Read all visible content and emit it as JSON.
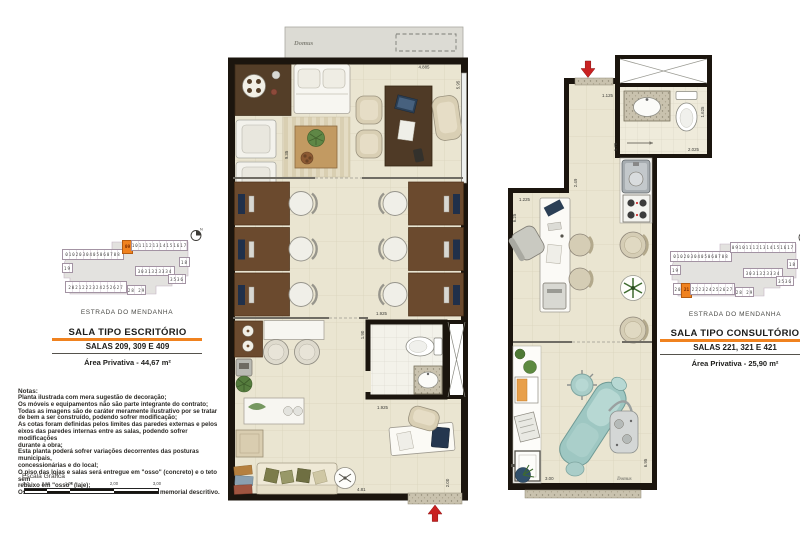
{
  "brand": {
    "logo_text": "Domus"
  },
  "left_panel": {
    "keyplan": {
      "north": "N",
      "street": "ESTRADA DO MENDANHA",
      "row2": "0102030405060708",
      "hl": "09",
      "top_right": "1011121314151617",
      "u18": "18",
      "u19": "19",
      "mid": "3031323334",
      "mid2": "3536",
      "bottom": "2021222324252627",
      "bottom2": "28 29"
    },
    "title": "SALA TIPO ESCRITÓRIO",
    "subtitle": "SALAS 209, 309 E 409",
    "area": "Área Privativa - 44,67 m²",
    "notes_title": "Notas:",
    "notes_body": "Planta ilustrada com mera sugestão de decoração;\nOs móveis e equipamentos não são parte integrante do contrato;\nTodas as imagens são de caráter meramente ilustrativo por se tratar\nde bem a ser construído, podendo sofrer modificação;\nAs cotas foram definidas pelos limites das paredes externas e pelos\neixos das paredes internas entre as salas, podendo sofrer modificações\ndurante a obra;\nEsta planta poderá sofrer variações decorrentes das posturas municipais,\nconcessionárias e do local;\nO piso das lojas e salas será entregue em \"osso\" (concreto) e o teto sem\nrebaixo em \"osso\" (laje);\nOs revestimentos serão executados conforme o memorial descritivo.",
    "scale_title": "Escala Gráfica",
    "scale_ticks": [
      "0,0",
      "0,50",
      "1,00",
      "2,00",
      "3,00"
    ]
  },
  "right_panel": {
    "keyplan": {
      "north": "N",
      "street": "ESTRADA DO MENDANHA",
      "row2": "0102030405060708",
      "top": "091011121314151617",
      "u18": "18",
      "u19": "19",
      "mid": "3031323334",
      "mid2": "3536",
      "bottom_pre": "20",
      "hl": "21",
      "bottom_post": "222324252627",
      "bottom2": "28 29"
    },
    "title": "SALA TIPO CONSULTÓRIO",
    "subtitle": "SALAS 221, 321 E 421",
    "area": "Área Privativa - 25,90 m²"
  },
  "plan_escritorio": {
    "dims": {
      "top_width": "4.885",
      "right_depth": "5.95",
      "left_depth": "9.35",
      "mid_opening": "1.925",
      "wc_width": "1.90",
      "wc_opening": "1.925",
      "bottom_width": "4.81",
      "entry_depth": "2.00"
    }
  },
  "plan_consultorio": {
    "dims": {
      "entry_width": "1.125",
      "corridor_depth": "1.70",
      "corridor_depth2": "2.49",
      "wc_depth": "1.625",
      "wc_width": "2.025",
      "room_width": "1.225",
      "room_depth": "6.25",
      "bottom_width": "3.00",
      "right_depth": "6.95"
    }
  }
}
